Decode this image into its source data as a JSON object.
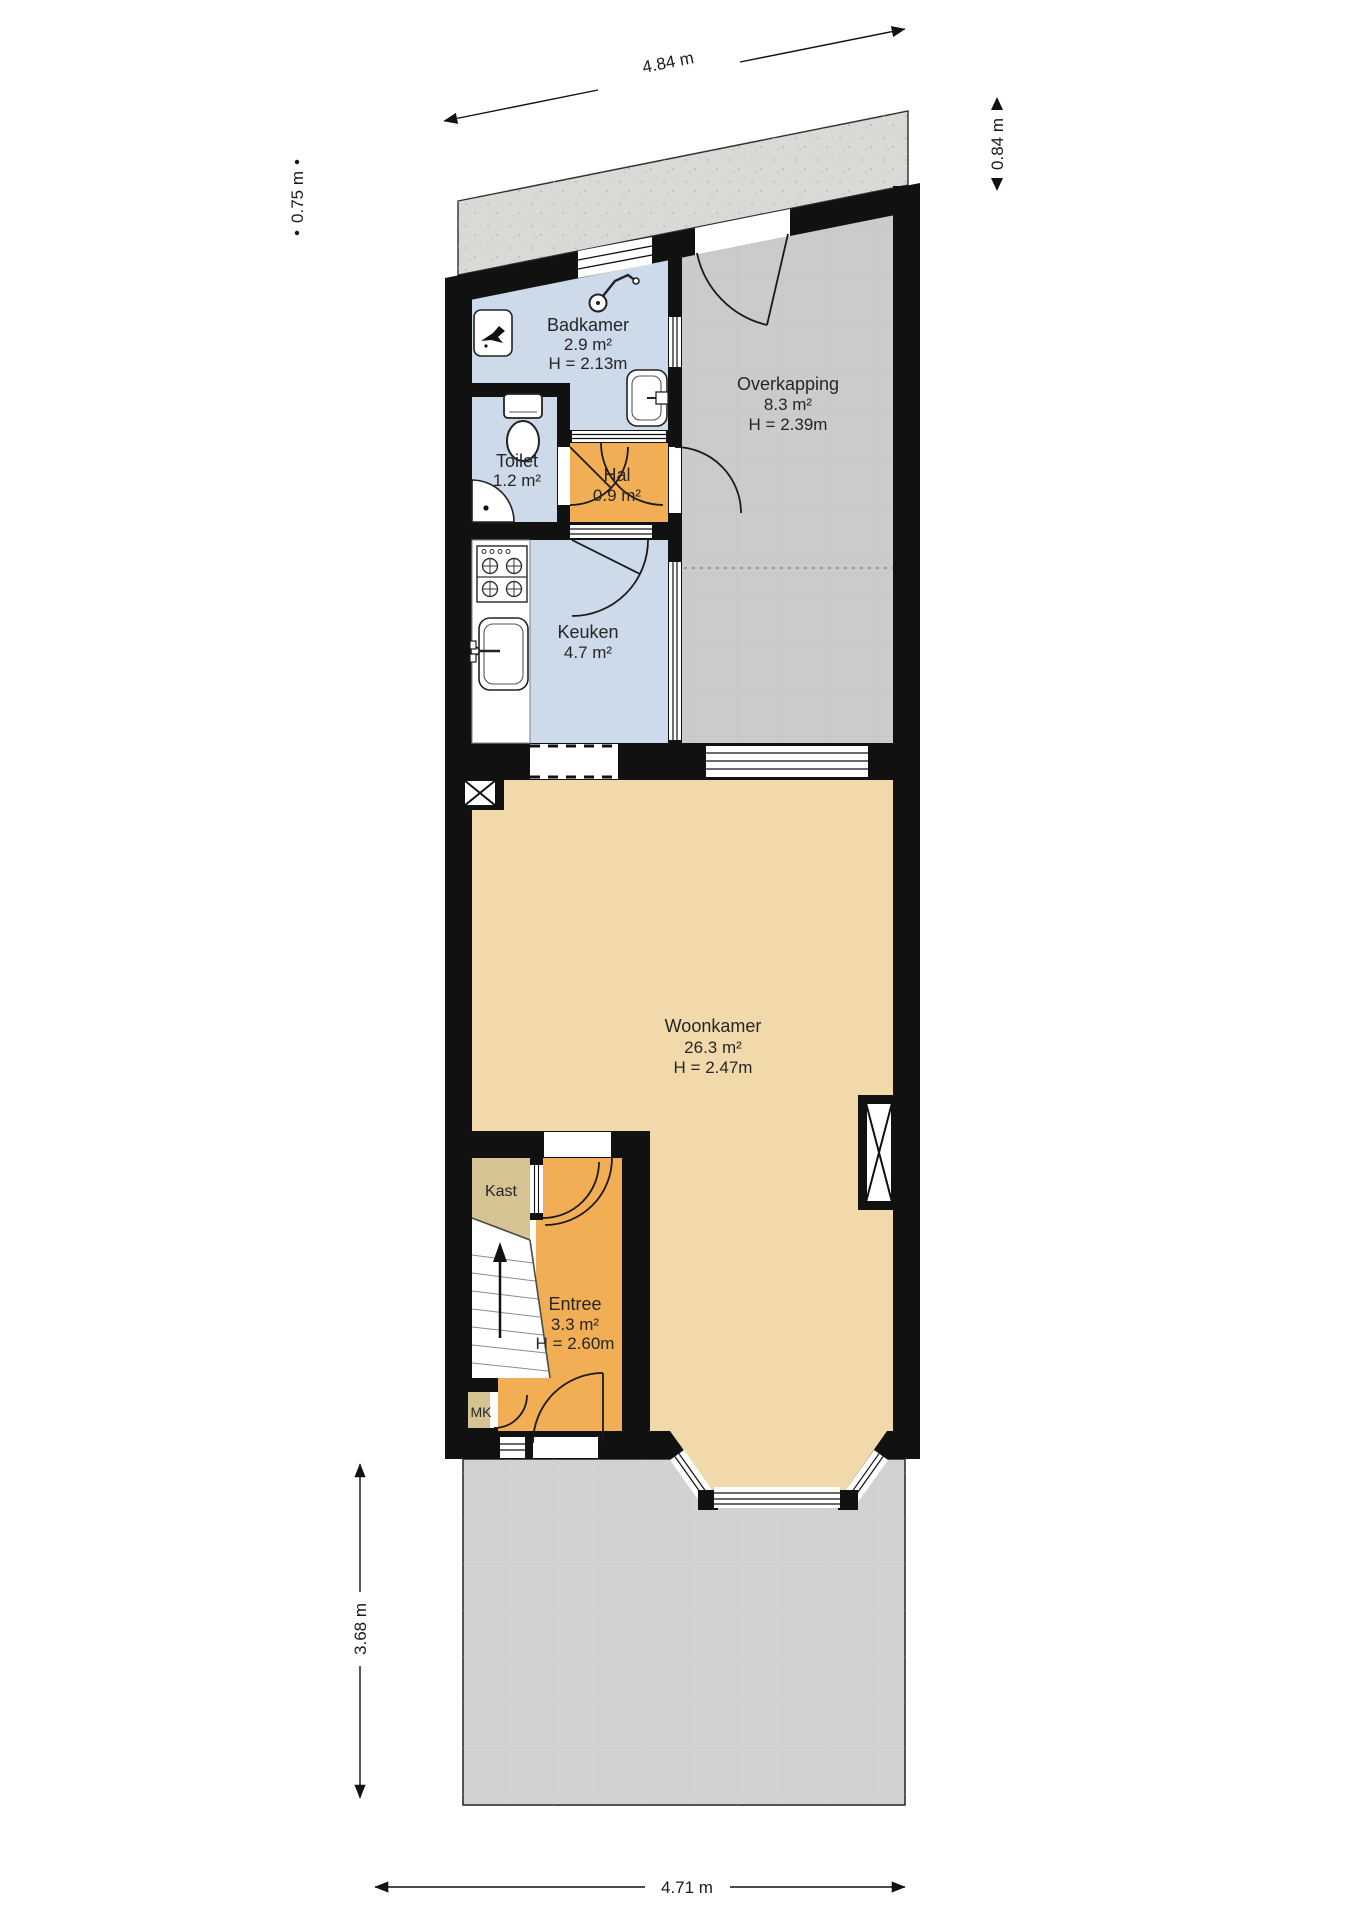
{
  "colors": {
    "wall": "#111111",
    "wet_room": "#CCDAE9",
    "hall": "#F2AE55",
    "living": "#F2D9AC",
    "closet": "#D6C394",
    "canopy": "#CBCBCB",
    "yard": "#D2D2D2",
    "concrete": "#D9D9D5"
  },
  "rooms": {
    "badkamer": {
      "name": "Badkamer",
      "area": "2.9 m²",
      "height": "H = 2.13m"
    },
    "toilet": {
      "name": "Toilet",
      "area": "1.2 m²"
    },
    "hal": {
      "name": "Hal",
      "area": "0.9 m²"
    },
    "overkapping": {
      "name": "Overkapping",
      "area": "8.3 m²",
      "height": "H = 2.39m"
    },
    "keuken": {
      "name": "Keuken",
      "area": "4.7 m²"
    },
    "woonkamer": {
      "name": "Woonkamer",
      "area": "26.3 m²",
      "height": "H = 2.47m"
    },
    "entree": {
      "name": "Entree",
      "area": "3.3 m²",
      "height": "H = 2.60m"
    },
    "kast": {
      "name": "Kast"
    },
    "meterkast": {
      "name": "MK"
    }
  },
  "dimensions": {
    "top": "4.84 m",
    "right_top": "0.84 m",
    "left_top": "0.75 m",
    "left_bottom": "3.68 m",
    "bottom": "4.71 m"
  }
}
